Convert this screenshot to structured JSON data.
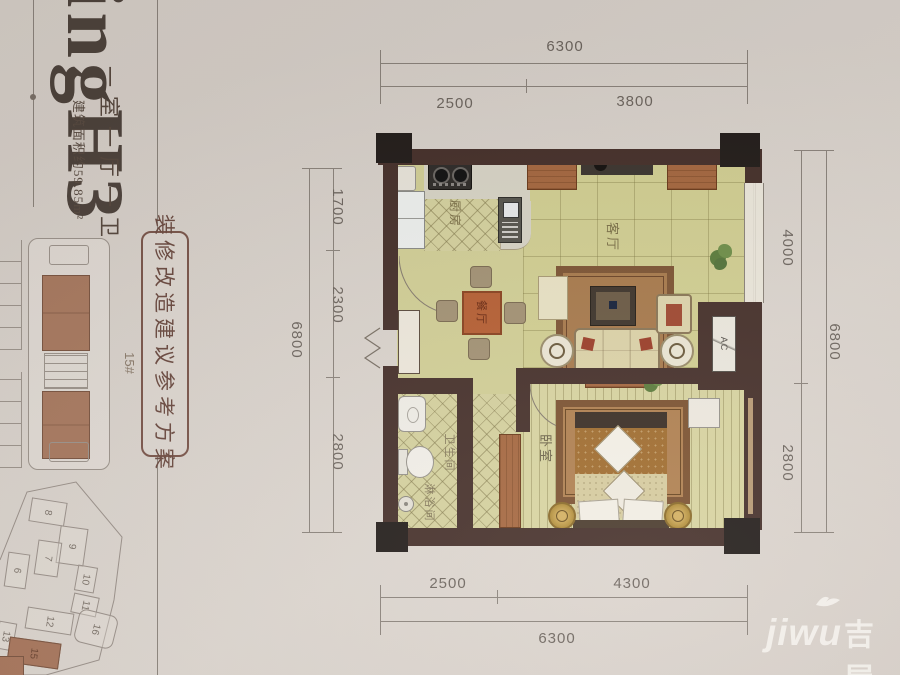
{
  "page": {
    "unit": {
      "code": "H3",
      "layout_desc": "一室一厅一卫",
      "area_desc": "建筑面积约59.85m²"
    },
    "proposal_box": "装修改造建议参考方案",
    "building_label": "15#",
    "site_buildings": [
      "8",
      "9",
      "7",
      "6",
      "10",
      "11",
      "12",
      "13",
      "16",
      "15"
    ],
    "rooms": {
      "kitchen": "厨房",
      "living": "客厅",
      "dining": "餐厅",
      "bath": "卫生间",
      "shower": "淋浴间",
      "bedroom": "卧室",
      "ac": "AC"
    },
    "dims": {
      "top_total": "6300",
      "top_a": "2500",
      "top_b": "3800",
      "left_a": "1700",
      "left_b": "2300",
      "left_c": "2800",
      "left_total": "6800",
      "right_a": "4000",
      "right_b": "2800",
      "right_total": "6800",
      "bottom_a": "2500",
      "bottom_b": "4300",
      "bottom_total": "6300"
    },
    "watermark": {
      "latin": "jiwu",
      "cn": "吉屋"
    }
  },
  "colors": {
    "wall": "#46302a",
    "paper": "#d8d1c9",
    "floor": "#d2cf96",
    "accent_wood": "#a5673f",
    "highlight_unit": "#a8765c",
    "dim_text": "#6e665f"
  }
}
